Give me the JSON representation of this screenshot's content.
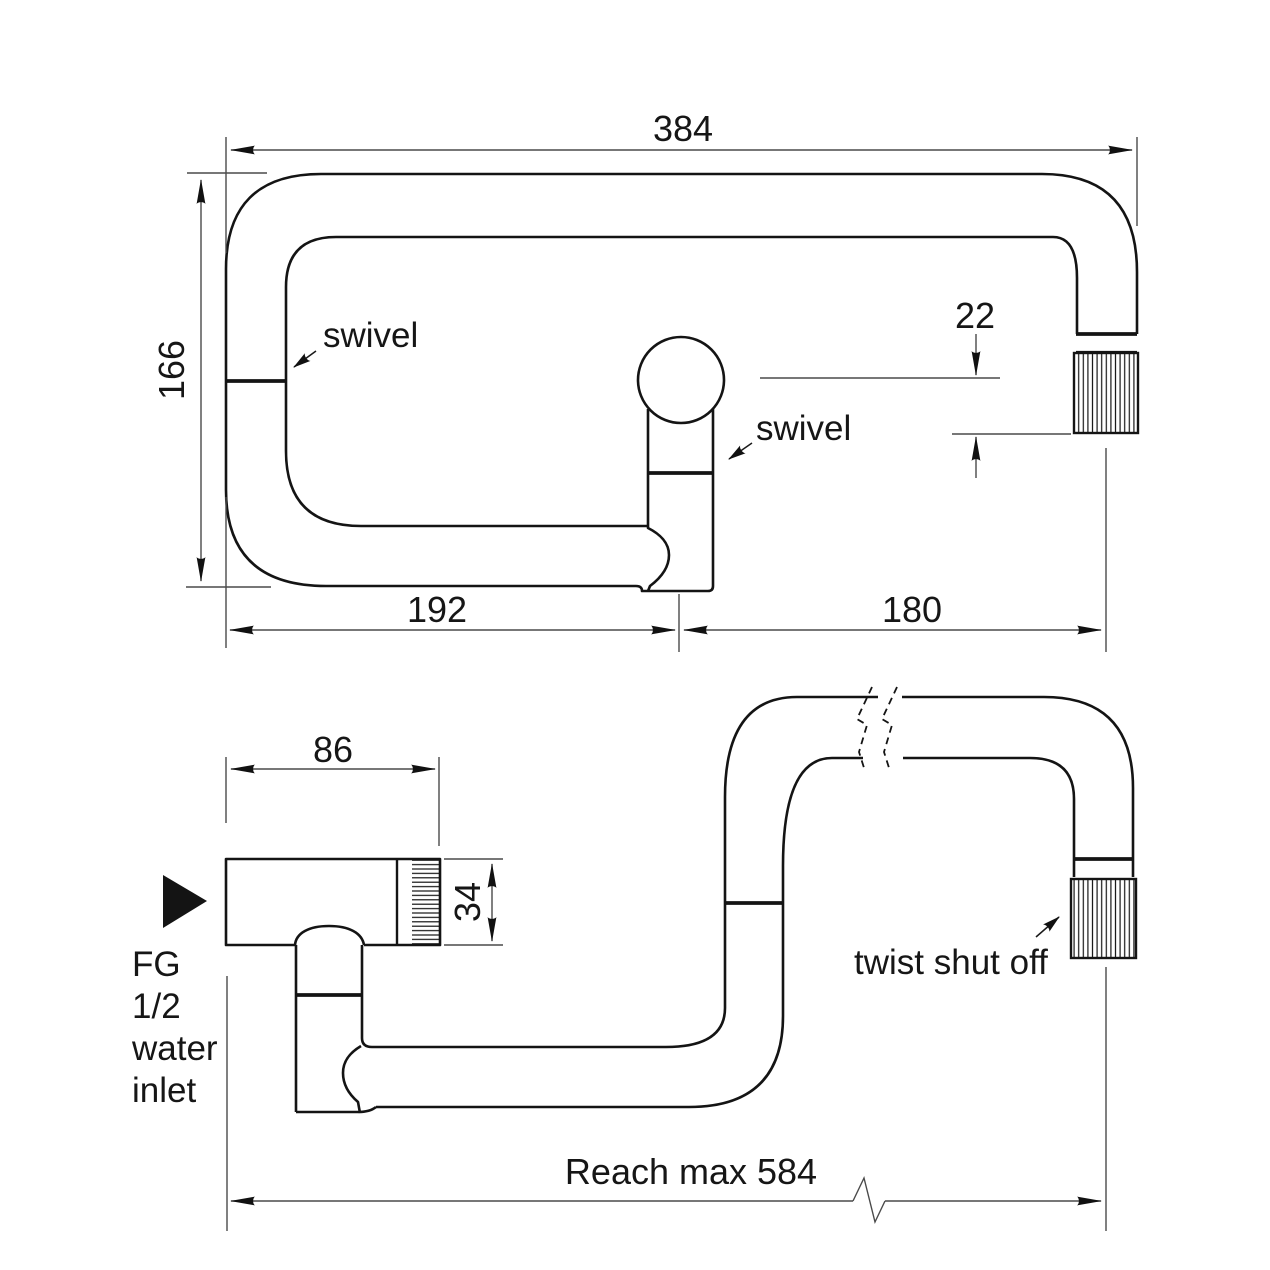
{
  "drawing": {
    "background": "#ffffff",
    "line_color": "#141414",
    "dimension_color": "#4a4a4a"
  },
  "top_view": {
    "dim_total_width": "384",
    "dim_total_depth": "166",
    "dim_left_span": "192",
    "dim_right_span": "180",
    "dim_spout_offset": "22",
    "label_swivel_arm": "swivel",
    "label_swivel_body": "swivel"
  },
  "side_view": {
    "dim_body_length": "86",
    "dim_body_height": "34",
    "dim_reach": "Reach max 584",
    "label_twist_shut_off": "twist shut off",
    "inlet_label_line1": "FG",
    "inlet_label_line2": "1/2",
    "inlet_label_line3": "water",
    "inlet_label_line4": "inlet"
  }
}
